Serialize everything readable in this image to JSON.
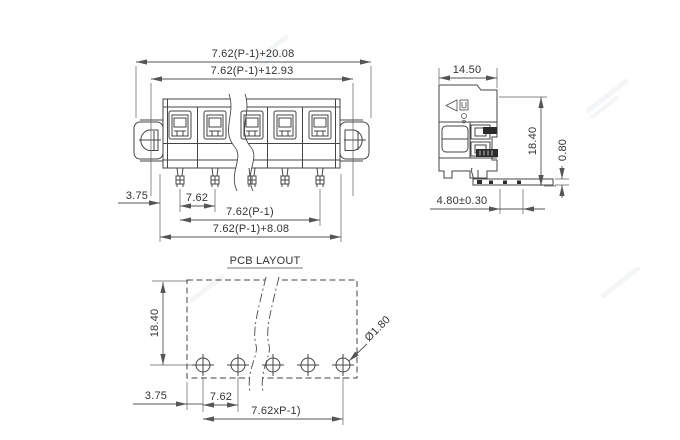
{
  "page": {
    "background": "#ffffff",
    "line_color": "#454545",
    "text_color": "#333333",
    "type": "terminal-block dimension drawing"
  },
  "front_view": {
    "positions": 5,
    "dim_top_overall": "7.62(P-1)+20.08",
    "dim_top_body": "7.62(P-1)+12.93",
    "dim_left_offset": "3.75",
    "dim_pitch": "7.62",
    "dim_pin_span": "7.62(P-1)",
    "dim_bottom_overall": "7.62(P-1)+8.08"
  },
  "side_view": {
    "dim_width": "14.50",
    "dim_height": "18.40",
    "dim_pin_thickness": "0.80",
    "dim_pin_length": "4.80±0.30"
  },
  "pcb_layout": {
    "title": "PCB LAYOUT",
    "hole_count": 5,
    "dim_height": "18.40",
    "dim_left_offset": "3.75",
    "dim_pitch": "7.62",
    "dim_span": "7.62xP-1)",
    "dim_hole_diameter": "Ø1.80"
  }
}
